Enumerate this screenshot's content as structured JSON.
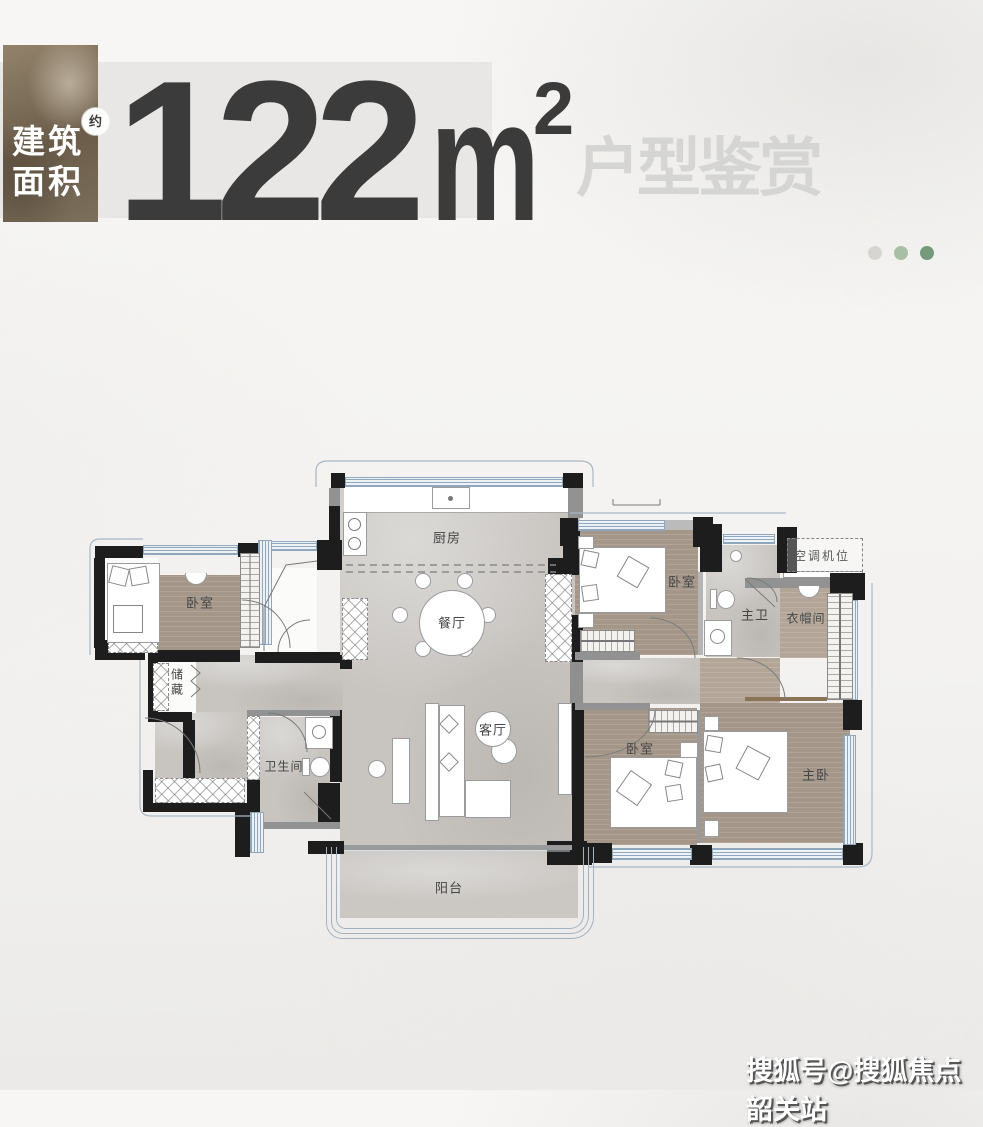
{
  "header": {
    "area_box": {
      "line1": "建筑",
      "line2": "面积",
      "badge": "约"
    },
    "area_value": "122",
    "area_unit": "m",
    "area_exponent": "2",
    "subtitle": "户型鉴赏"
  },
  "pagination": {
    "dot_colors": [
      "#d7d5d1",
      "#a9bfa5",
      "#75997b"
    ]
  },
  "floorplan": {
    "labels": {
      "kitchen": "厨房",
      "dining": "餐厅",
      "living": "客厅",
      "balcony": "阳台",
      "bedroom_left": "卧室",
      "storage": "储藏",
      "bathroom": "卫生间",
      "bedroom_top_right": "卧室",
      "master_bath": "主卫",
      "cloakroom": "衣帽间",
      "ac_slot": "空调机位",
      "bedroom_bottom": "卧室",
      "master_bedroom": "主卧"
    }
  },
  "colors": {
    "accent_brown": "#7d6f5a",
    "marble_floor": "#c8c5c1",
    "wood_floor": "#a4978a",
    "number_text": "#3b3b3b",
    "subtitle_text": "#d5d5d4"
  },
  "watermark": {
    "text": "搜狐号@搜狐焦点韶关站"
  }
}
